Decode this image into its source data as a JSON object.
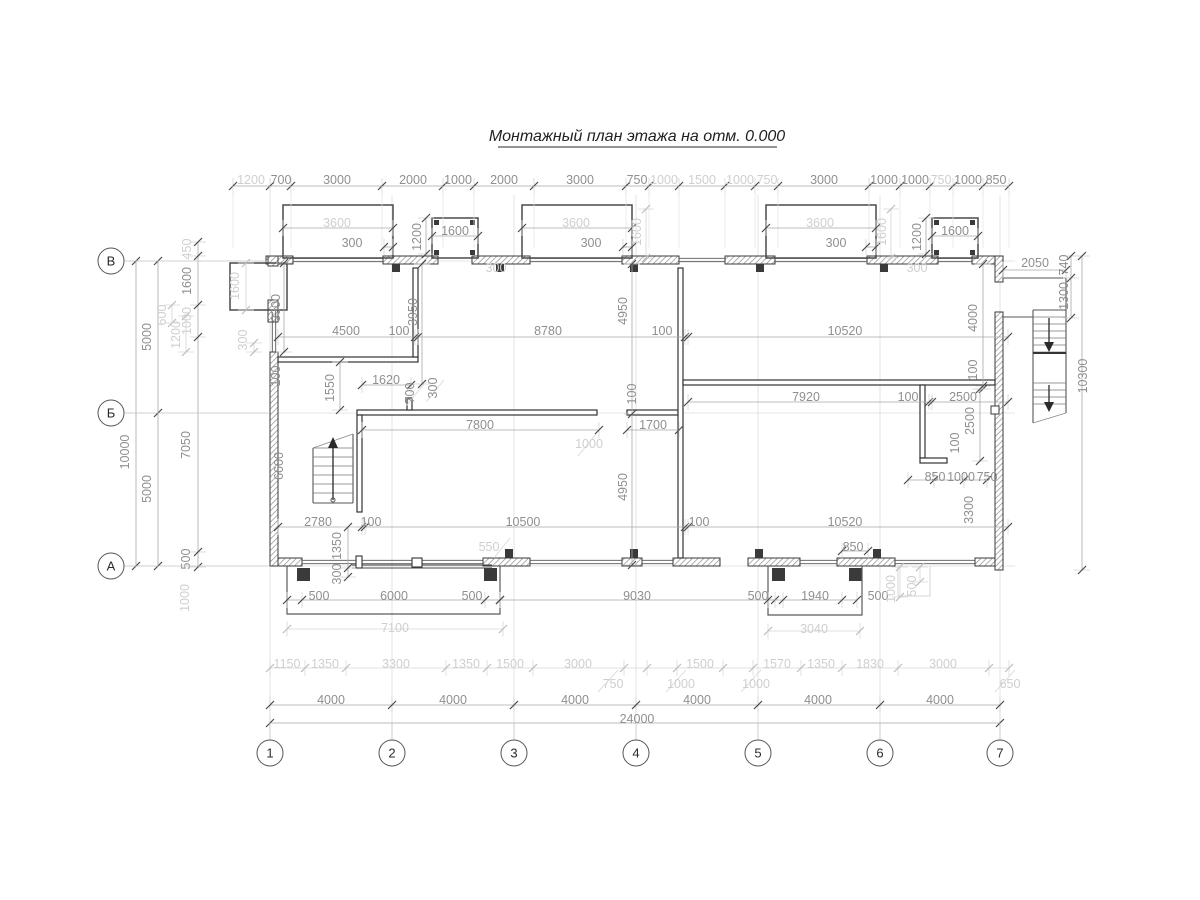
{
  "title": {
    "text": "Монтажный план этажа на отм. 0.000"
  },
  "colors": {
    "wall_line": "#3a3a3a",
    "dim_text": "#8f8f8f",
    "dim_text_light": "#cfcfcf",
    "dim_line": "#a8a8a8",
    "dim_line_light": "#d6d6d6",
    "tick": "#4a4a4a",
    "grid_line": "#dcdcdc",
    "axis_text": "#2a2a2a"
  },
  "grid": {
    "horizontal_axes": [
      {
        "label": "В"
      },
      {
        "label": "Б"
      },
      {
        "label": "А"
      }
    ],
    "vertical_axes": [
      {
        "label": "1"
      },
      {
        "label": "2"
      },
      {
        "label": "3"
      },
      {
        "label": "4"
      },
      {
        "label": "5"
      },
      {
        "label": "6"
      },
      {
        "label": "7"
      }
    ]
  },
  "dimensions": {
    "units": "mm",
    "labels": [
      [
        "1200",
        251,
        180,
        0,
        1
      ],
      [
        "700",
        281,
        180,
        0,
        0
      ],
      [
        "3000",
        337,
        180,
        0,
        0
      ],
      [
        "2000",
        413,
        180,
        0,
        0
      ],
      [
        "1000",
        458,
        180,
        0,
        0
      ],
      [
        "2000",
        504,
        180,
        0,
        0
      ],
      [
        "3000",
        580,
        180,
        0,
        0
      ],
      [
        "750",
        637,
        180,
        0,
        0
      ],
      [
        "1000",
        664,
        180,
        0,
        1
      ],
      [
        "1500",
        702,
        180,
        0,
        1
      ],
      [
        "1000",
        740,
        180,
        0,
        1
      ],
      [
        "750",
        767,
        180,
        0,
        1
      ],
      [
        "3000",
        824,
        180,
        0,
        0
      ],
      [
        "1000",
        884,
        180,
        0,
        0
      ],
      [
        "1000",
        915,
        180,
        0,
        0
      ],
      [
        "750",
        941,
        180,
        0,
        1
      ],
      [
        "1000",
        968,
        180,
        0,
        0
      ],
      [
        "850",
        996,
        180,
        0,
        0
      ],
      [
        "3600",
        337,
        223,
        0,
        1
      ],
      [
        "3600",
        576,
        223,
        0,
        1
      ],
      [
        "3600",
        820,
        223,
        0,
        1
      ],
      [
        "300",
        352,
        243,
        0,
        0
      ],
      [
        "300",
        591,
        243,
        0,
        0
      ],
      [
        "300",
        836,
        243,
        0,
        0
      ],
      [
        "1600",
        455,
        231,
        0,
        0
      ],
      [
        "1200",
        421,
        237,
        1,
        0
      ],
      [
        "300",
        496,
        268,
        0,
        1
      ],
      [
        "1600",
        955,
        231,
        0,
        0
      ],
      [
        "1200",
        921,
        237,
        1,
        0
      ],
      [
        "300",
        917,
        268,
        0,
        1
      ],
      [
        "1600",
        641,
        232,
        1,
        1
      ],
      [
        "1600",
        886,
        232,
        1,
        1
      ],
      [
        "1600",
        239,
        286,
        1,
        1
      ],
      [
        "300",
        247,
        340,
        1,
        1
      ],
      [
        "3300",
        280,
        308,
        1,
        0
      ],
      [
        "450",
        191,
        249,
        1,
        1
      ],
      [
        "1600",
        191,
        281,
        1,
        0
      ],
      [
        "1000",
        191,
        321,
        1,
        1
      ],
      [
        "5000",
        151,
        337,
        1,
        0
      ],
      [
        "10000",
        129,
        452,
        1,
        0
      ],
      [
        "5000",
        151,
        489,
        1,
        0
      ],
      [
        "7050",
        190,
        445,
        1,
        0
      ],
      [
        "500",
        190,
        559,
        1,
        0
      ],
      [
        "600",
        166,
        315,
        1,
        1
      ],
      [
        "1200",
        180,
        335,
        1,
        1
      ],
      [
        "1000",
        189,
        598,
        1,
        1
      ],
      [
        "100",
        280,
        376,
        1,
        0
      ],
      [
        "4500",
        346,
        331,
        0,
        0
      ],
      [
        "100",
        399,
        331,
        0,
        0
      ],
      [
        "8780",
        548,
        331,
        0,
        0
      ],
      [
        "100",
        662,
        331,
        0,
        0
      ],
      [
        "10520",
        845,
        331,
        0,
        0
      ],
      [
        "3950",
        417,
        312,
        1,
        0
      ],
      [
        "4950",
        627,
        311,
        1,
        0
      ],
      [
        "100",
        636,
        394,
        1,
        0
      ],
      [
        "4950",
        627,
        487,
        1,
        0
      ],
      [
        "4000",
        977,
        318,
        1,
        0
      ],
      [
        "100",
        977,
        370,
        1,
        0
      ],
      [
        "2050",
        1035,
        263,
        0,
        0
      ],
      [
        "740",
        1068,
        265,
        1,
        0
      ],
      [
        "1300",
        1068,
        296,
        1,
        0
      ],
      [
        "10300",
        1087,
        376,
        1,
        0
      ],
      [
        "1550",
        334,
        388,
        1,
        0
      ],
      [
        "1620",
        386,
        380,
        0,
        0
      ],
      [
        "700",
        414,
        393,
        1,
        0
      ],
      [
        "300",
        437,
        388,
        1,
        0
      ],
      [
        "7800",
        480,
        425,
        0,
        0
      ],
      [
        "1000",
        589,
        444,
        0,
        1
      ],
      [
        "1700",
        653,
        425,
        0,
        0
      ],
      [
        "7920",
        806,
        397,
        0,
        0
      ],
      [
        "100",
        908,
        397,
        0,
        0
      ],
      [
        "2500",
        963,
        397,
        0,
        0
      ],
      [
        "2500",
        974,
        421,
        1,
        0
      ],
      [
        "100",
        959,
        443,
        1,
        0
      ],
      [
        "850",
        935,
        477,
        0,
        0
      ],
      [
        "1000",
        961,
        477,
        0,
        0
      ],
      [
        "750",
        987,
        477,
        0,
        0
      ],
      [
        "3300",
        973,
        510,
        1,
        0
      ],
      [
        "2780",
        318,
        522,
        0,
        0
      ],
      [
        "100",
        371,
        522,
        0,
        0
      ],
      [
        "1350",
        341,
        546,
        1,
        0
      ],
      [
        "300",
        341,
        574,
        1,
        0
      ],
      [
        "6600",
        283,
        466,
        1,
        0
      ],
      [
        "10500",
        523,
        522,
        0,
        0
      ],
      [
        "100",
        699,
        522,
        0,
        0
      ],
      [
        "10520",
        845,
        522,
        0,
        0
      ],
      [
        "550",
        489,
        547,
        0,
        1
      ],
      [
        "850",
        853,
        547,
        0,
        0
      ],
      [
        "500",
        319,
        596,
        0,
        0
      ],
      [
        "6000",
        394,
        596,
        0,
        0
      ],
      [
        "500",
        472,
        596,
        0,
        0
      ],
      [
        "9030",
        637,
        596,
        0,
        0
      ],
      [
        "500",
        758,
        596,
        0,
        0
      ],
      [
        "1940",
        815,
        596,
        0,
        0
      ],
      [
        "500",
        878,
        596,
        0,
        0
      ],
      [
        "7100",
        395,
        628,
        0,
        1
      ],
      [
        "3040",
        814,
        629,
        0,
        1
      ],
      [
        "1000",
        895,
        589,
        1,
        1
      ],
      [
        "500",
        916,
        586,
        1,
        1
      ],
      [
        "1150",
        287,
        664,
        0,
        1
      ],
      [
        "1350",
        325,
        664,
        0,
        1
      ],
      [
        "3300",
        396,
        664,
        0,
        1
      ],
      [
        "1350",
        466,
        664,
        0,
        1
      ],
      [
        "1500",
        510,
        664,
        0,
        1
      ],
      [
        "3000",
        578,
        664,
        0,
        1
      ],
      [
        "1500",
        700,
        664,
        0,
        1
      ],
      [
        "1570",
        777,
        664,
        0,
        1
      ],
      [
        "1350",
        821,
        664,
        0,
        1
      ],
      [
        "1830",
        870,
        664,
        0,
        1
      ],
      [
        "3000",
        943,
        664,
        0,
        1
      ],
      [
        "750",
        613,
        684,
        0,
        1
      ],
      [
        "1000",
        681,
        684,
        0,
        1
      ],
      [
        "1000",
        756,
        684,
        0,
        1
      ],
      [
        "650",
        1010,
        684,
        0,
        1
      ],
      [
        "4000",
        331,
        700,
        0,
        0
      ],
      [
        "4000",
        453,
        700,
        0,
        0
      ],
      [
        "4000",
        575,
        700,
        0,
        0
      ],
      [
        "4000",
        697,
        700,
        0,
        0
      ],
      [
        "4000",
        818,
        700,
        0,
        0
      ],
      [
        "4000",
        940,
        700,
        0,
        0
      ],
      [
        "24000",
        637,
        719,
        0,
        0
      ]
    ]
  }
}
